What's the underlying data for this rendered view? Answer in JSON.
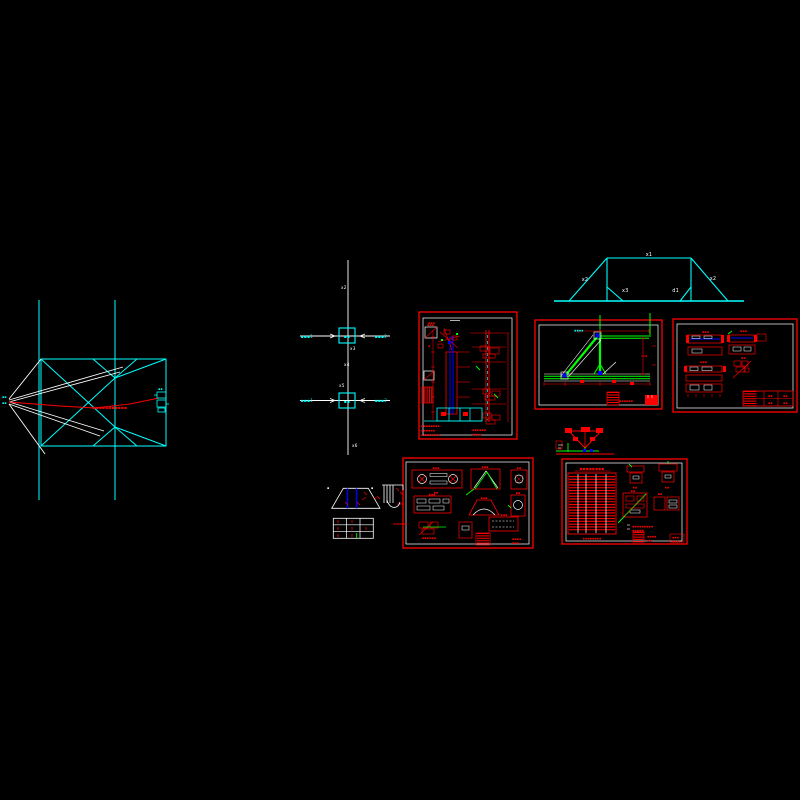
{
  "app": {
    "background": "#000000"
  },
  "colors": {
    "cyan": "#00ffff",
    "white": "#ffffff",
    "red": "#ff0000",
    "green": "#00ff00",
    "blue": "#0000ff"
  },
  "bracing_elevation": {
    "apex_note_1": "▪▪",
    "apex_note_2": "▪▪",
    "center_annotation": "▪▪▪▪▪▪▪▪▪▪▪",
    "connector_note": "▪▪"
  },
  "column_schematic": {
    "top_mark": "x2",
    "node1_left": "▪▪▪1",
    "node1_right": "▪▪▪2",
    "node1_inner": "▪▪",
    "node1_below": "x3",
    "mid_mark_1": "x4",
    "mid_mark_2": "x5",
    "node2_left": "▪▪▪1",
    "node2_right": "▪▪▪2",
    "node2_inner": "▪▪",
    "bottom_mark": "x6"
  },
  "portal_frame": {
    "top_span": "x1",
    "left_diag": "x2",
    "right_diag": "x2",
    "inner_left": "x3",
    "inner_right": "d1"
  },
  "sheet_column": {
    "texts": [
      "▪▪▪",
      "▪▪▪",
      "▪▪▪▪▪▪▪▪",
      "▪▪▪▪▪▪",
      "▪▪▪▪▪▪▪▪",
      "▪▪▪▪▪▪",
      "▪▪▪▪",
      "▪"
    ]
  },
  "sheet_truss": {
    "texts": [
      "▪▪▪▪",
      "▪▪▪▪▪▪",
      "▪"
    ]
  },
  "sheet_beams": {
    "texts": [
      "▪▪▪",
      "▪▪▪",
      "▪▪",
      "▪▪▪",
      "▪▪",
      "▪▪",
      "▪▪",
      "▪▪"
    ]
  },
  "sheet_gussets": {
    "texts": [
      "▪▪▪",
      "▪▪",
      "▪▪▪",
      "▪▪",
      "▪▪▪",
      "▪▪▪",
      "▪▪",
      "▪▪▪▪▪▪",
      "▪▪▪",
      "▪▪▪▪",
      "▪▪▪"
    ]
  },
  "sheet_schedule": {
    "texts": [
      "▪▪▪▪▪▪▪▪",
      "▪▪",
      "▪▪",
      "▪▪",
      "▪▪",
      "▪▪▪▪▪▪▪▪▪",
      "▪▪▪▪▪",
      "▪▪▪▪",
      "▪▪",
      "▪▪▪",
      "▪▪▪",
      "▪▪▪▪▪▪▪▪"
    ]
  },
  "pedestal": {
    "mark_left": "▪",
    "mark_right": "▪"
  }
}
